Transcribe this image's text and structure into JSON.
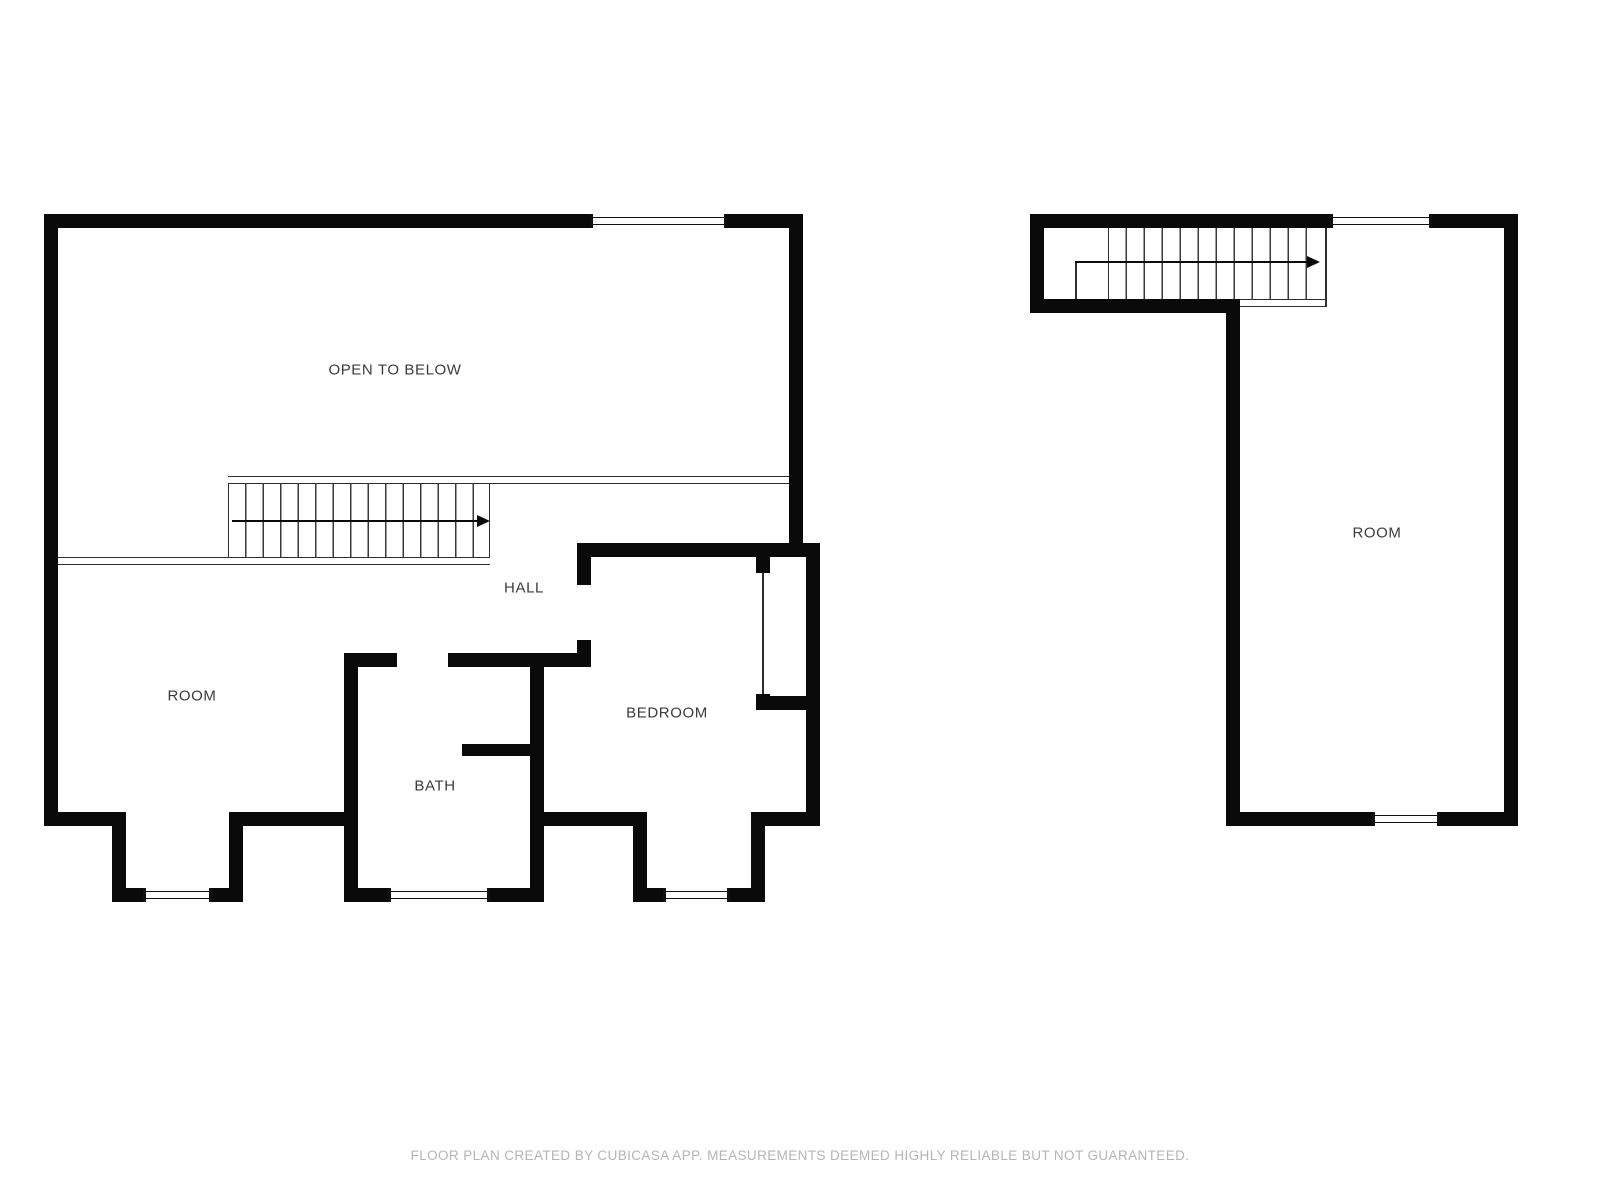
{
  "page": {
    "background": "#ffffff",
    "wall_color": "#0a0a0a",
    "thin_line_color": "#2e2e2e",
    "label_color": "#3b3b3b",
    "footer_color": "#b5b5b5"
  },
  "floorplan": {
    "left_unit": {
      "labels": {
        "open_to_below": "OPEN TO BELOW",
        "hall": "HALL",
        "room": "ROOM",
        "bath": "BATH",
        "bedroom": "BEDROOM"
      }
    },
    "right_unit": {
      "labels": {
        "room": "ROOM"
      }
    },
    "footer": {
      "text": "FLOOR PLAN CREATED BY CUBICASA APP. MEASUREMENTS DEEMED HIGHLY RELIABLE BUT NOT GUARANTEED."
    }
  }
}
